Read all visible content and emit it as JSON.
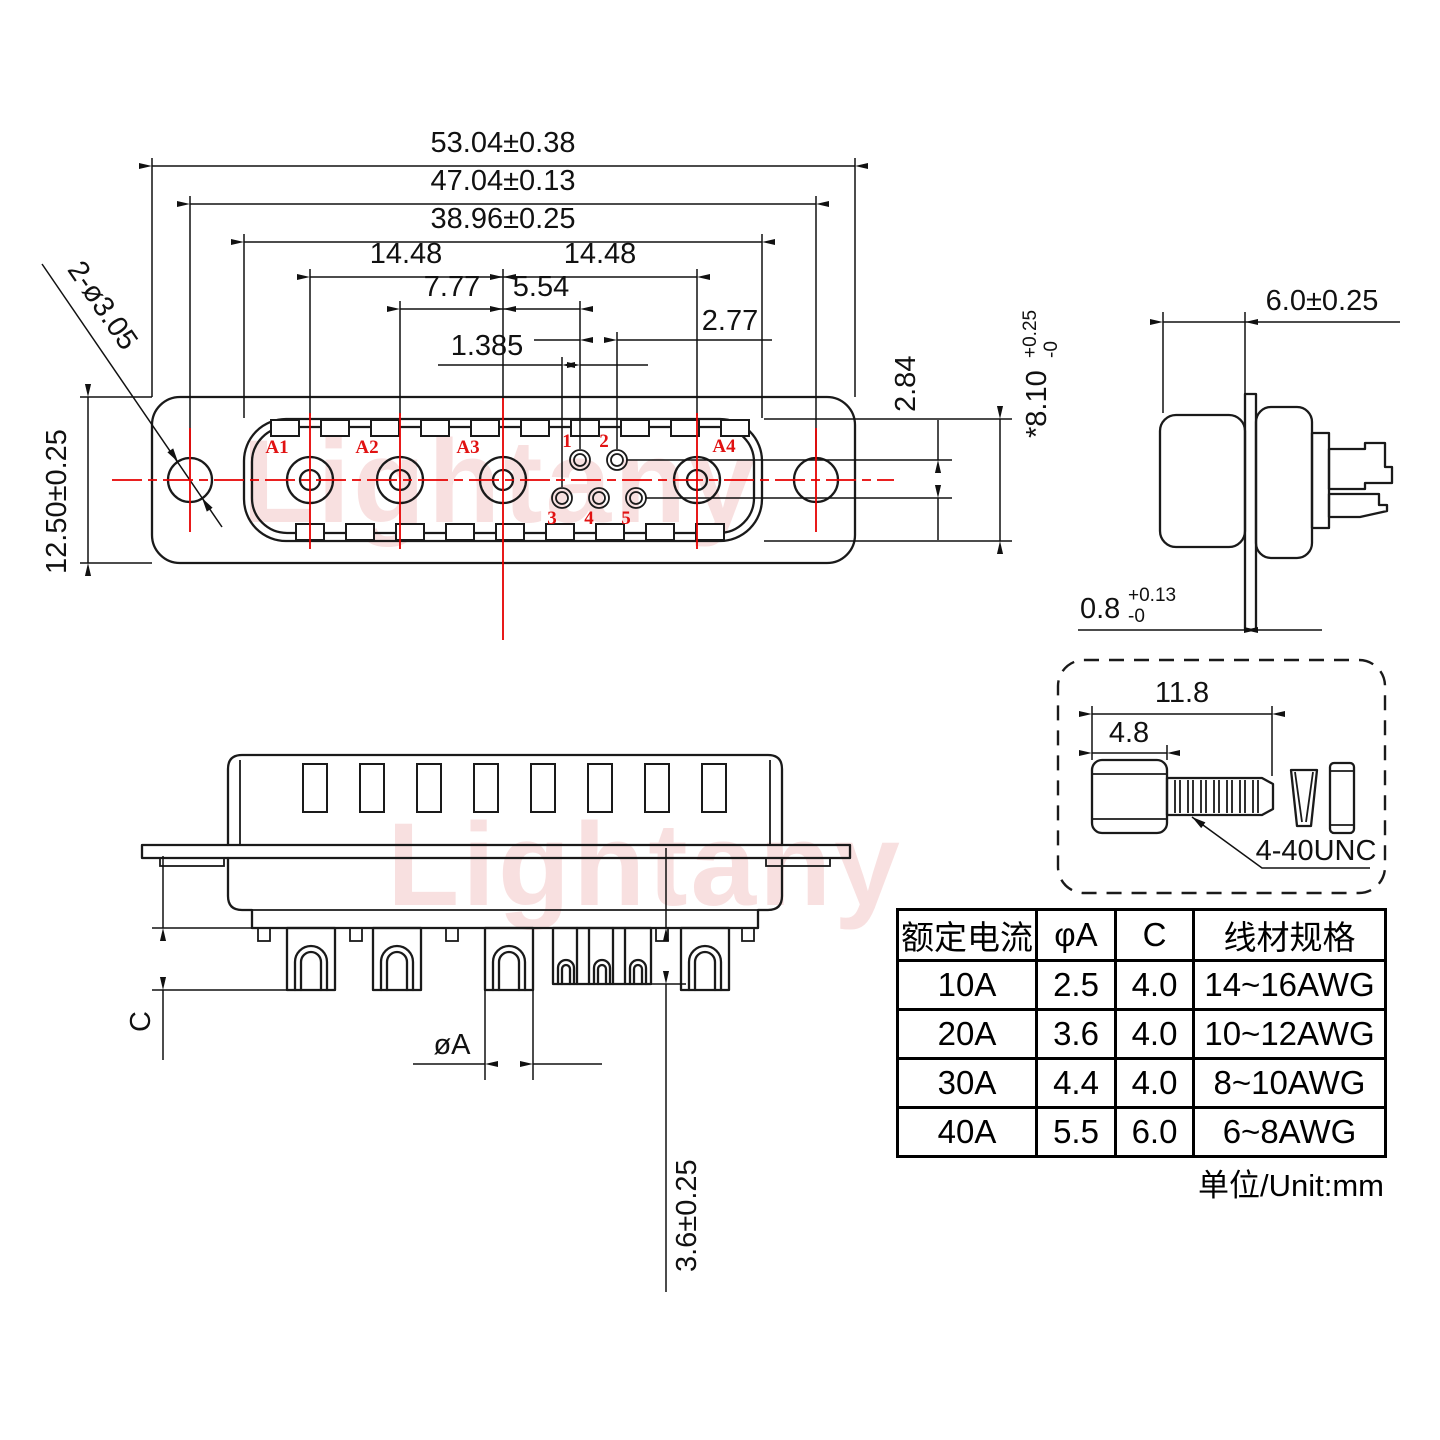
{
  "watermark": {
    "text": "Lightany",
    "color": "#f2c2c2"
  },
  "colors": {
    "line": "#1a1a1a",
    "centerline": "#e60000",
    "pin_label": "#e11212"
  },
  "front_view": {
    "pin_labels": [
      "A1",
      "A2",
      "A3",
      "A4"
    ],
    "small_pin_labels": [
      "1",
      "2",
      "3",
      "4",
      "5"
    ],
    "dims": {
      "width_outer": "53.04±0.38",
      "width_holes": "47.04±0.13",
      "width_face": "38.96±0.25",
      "pitch_left": "14.48",
      "pitch_right": "14.48",
      "a2_offset": "7.77",
      "pin1_offset": "5.54",
      "pin_pitch": "2.77",
      "row_offset": "1.385",
      "row_gap": "2.84",
      "face_height": "*8.10",
      "face_height_tol_plus": "+0.25",
      "face_height_tol_minus": "-0",
      "height": "12.50±0.25",
      "mount_holes": "2-ø3.05"
    }
  },
  "side_view": {
    "dims": {
      "depth": "6.0±0.25",
      "flange_thickness": "0.8",
      "flange_tol_plus": "+0.13",
      "flange_tol_minus": "-0"
    }
  },
  "screw_detail": {
    "dims": {
      "total_length": "11.8",
      "head_length": "4.8"
    },
    "thread_label": "4-40UNC"
  },
  "bottom_view": {
    "dims": {
      "cup_depth": "C",
      "pin_diameter": "øA",
      "pin_length": "3.6±0.25"
    }
  },
  "spec_table": {
    "headers": [
      "额定电流",
      "φA",
      "C",
      "线材规格"
    ],
    "rows": [
      [
        "10A",
        "2.5",
        "4.0",
        "14~16AWG"
      ],
      [
        "20A",
        "3.6",
        "4.0",
        "10~12AWG"
      ],
      [
        "30A",
        "4.4",
        "4.0",
        "8~10AWG"
      ],
      [
        "40A",
        "5.5",
        "6.0",
        "6~8AWG"
      ]
    ],
    "unit_note": "单位/Unit:mm"
  }
}
